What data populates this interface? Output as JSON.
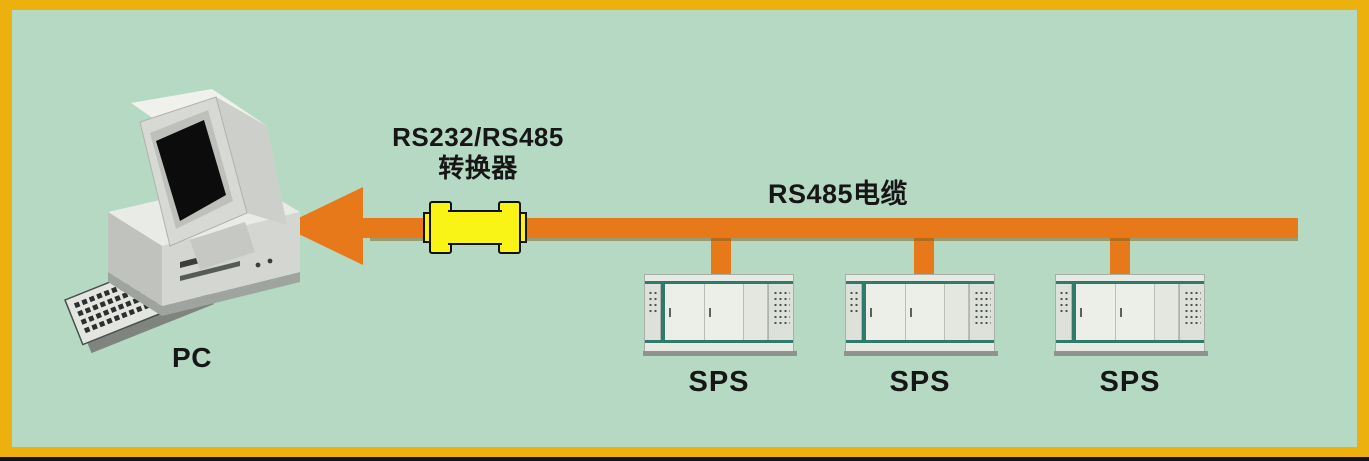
{
  "diagram": {
    "pc": {
      "label": "PC"
    },
    "converter": {
      "label_line1": "RS232/RS485",
      "label_line2": "转换器"
    },
    "cable": {
      "label": "RS485电缆"
    },
    "sps_units": [
      {
        "label": "SPS"
      },
      {
        "label": "SPS"
      },
      {
        "label": "SPS"
      }
    ],
    "colors": {
      "background": "#B6D9C4",
      "frame": "#EDB10E",
      "bottom_bar": "#141414",
      "cable_orange": "#E8791B",
      "converter_yellow": "#FAF316",
      "cabinet_teal": "#2F7A6B",
      "cabinet_body": "#E7EAE3",
      "text": "#161616"
    }
  }
}
